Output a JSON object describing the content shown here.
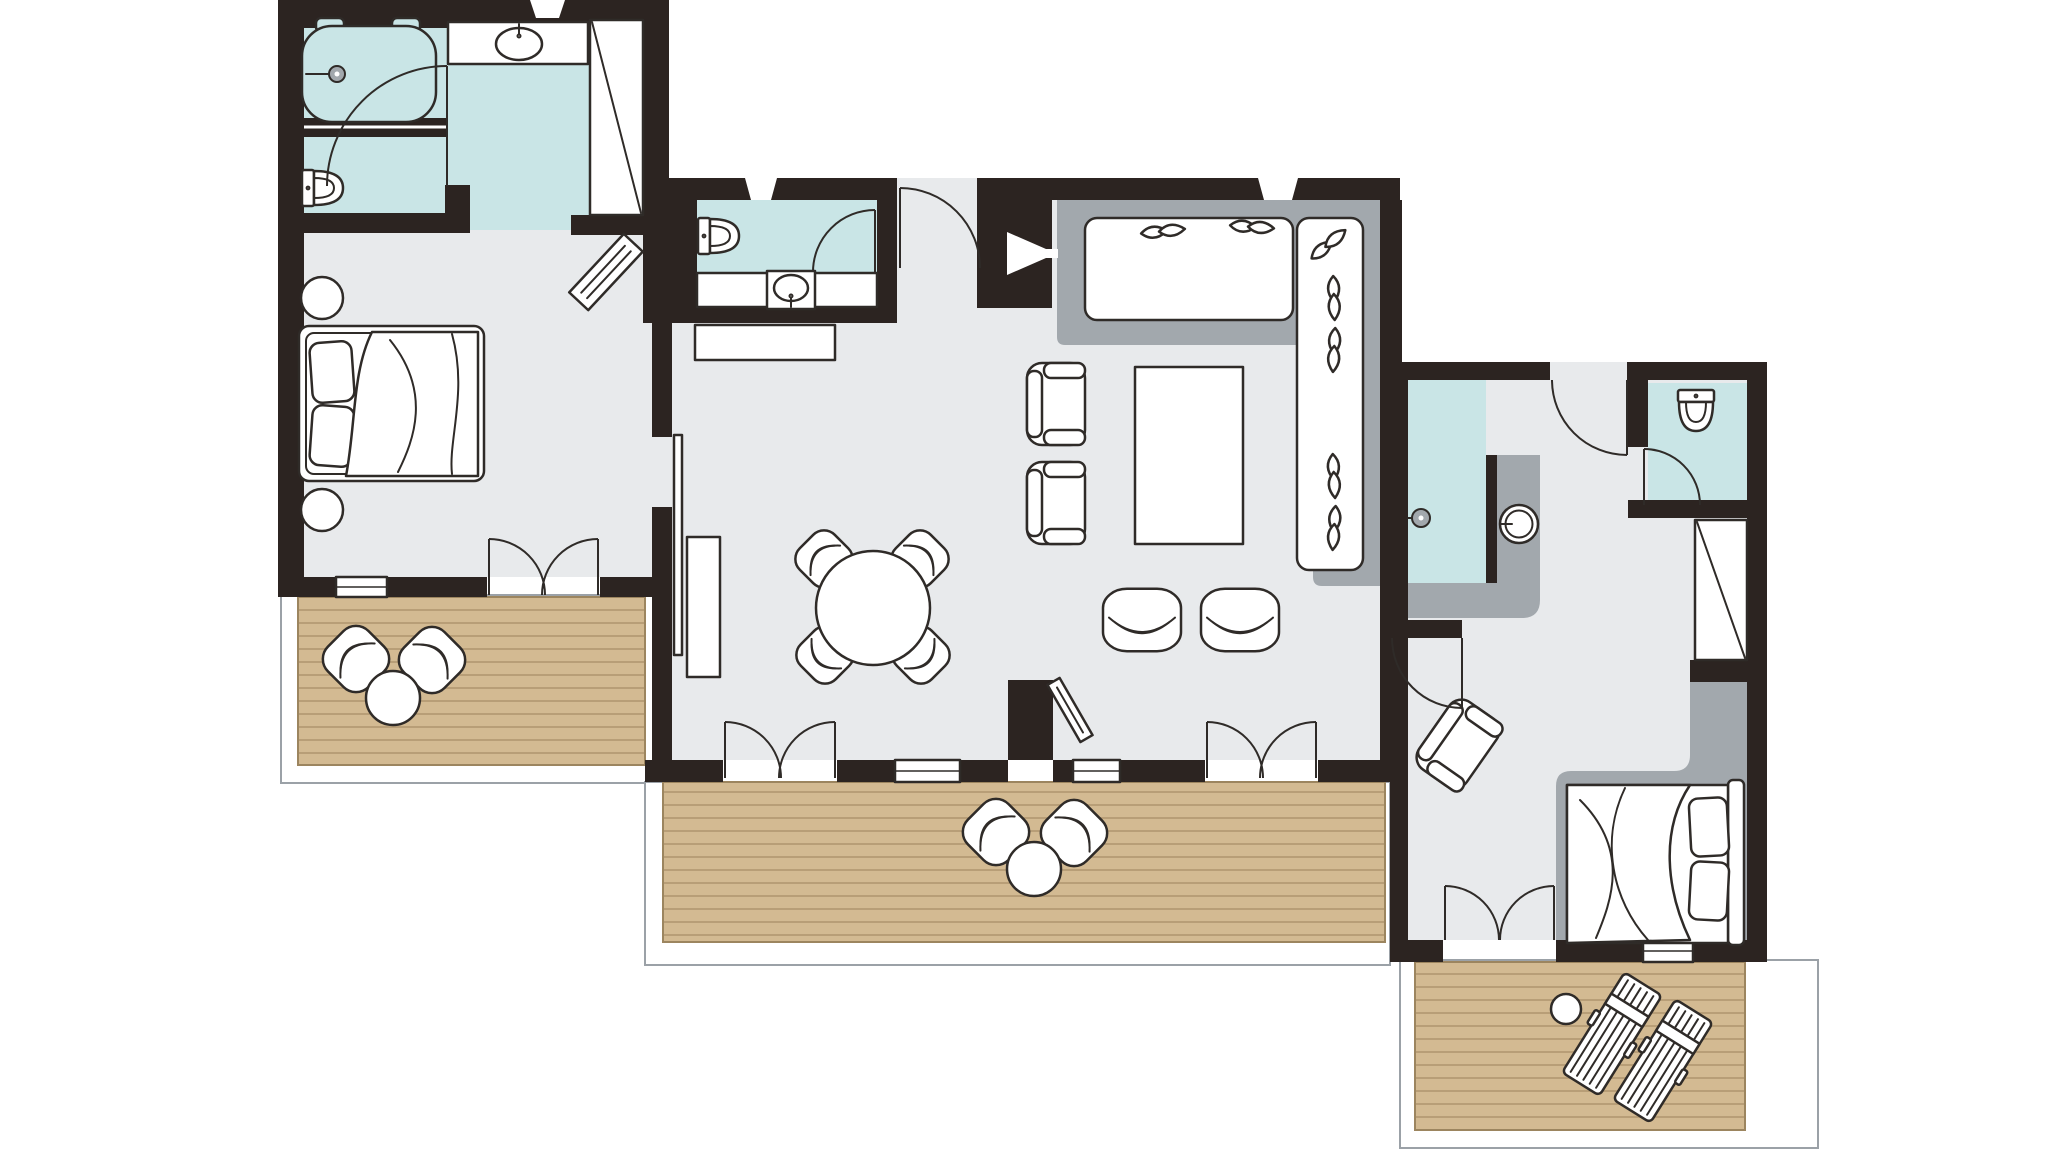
{
  "colors": {
    "bg": "#ffffff",
    "wall": "#2c2421",
    "floor": "#e8eaec",
    "bath": "#c9e5e6",
    "deck": "#d3ba92",
    "deck_line": "#b89e77",
    "deck_edge": "#9c855f",
    "accent": "#a2a8ad",
    "stroke": "#2f2b28",
    "frame": "#9ba1a7",
    "white": "#ffffff"
  },
  "floorplan": {
    "type": "two-bedroom suite floor plan",
    "units": [
      {
        "name": "master bedroom unit",
        "rooms": [
          "bathroom",
          "wc compartment",
          "bedroom",
          "terrace"
        ],
        "furniture": [
          "bathtub",
          "washbasin",
          "toilet",
          "wardrobe",
          "double bed",
          "nightstand",
          "nightstand",
          "luggage bench",
          "terrace chair",
          "terrace chair",
          "terrace table"
        ]
      },
      {
        "name": "living unit",
        "rooms": [
          "guest bathroom",
          "entrance hall",
          "living room",
          "dining area",
          "terrace"
        ],
        "furniture": [
          "toilet",
          "washbasin",
          "console table",
          "corner sofa",
          "sofa cushions",
          "coffee table",
          "armchair",
          "armchair",
          "lounge chair",
          "lounge chair",
          "tv panel",
          "round dining table",
          "dining chair",
          "dining chair",
          "dining chair",
          "dining chair",
          "sideboard",
          "sliding door",
          "terrace chair",
          "terrace chair",
          "terrace table"
        ]
      },
      {
        "name": "second bedroom unit",
        "rooms": [
          "shower room",
          "wc",
          "dressing hall",
          "bedroom",
          "terrace"
        ],
        "furniture": [
          "walk-in shower",
          "shower head",
          "washbasin",
          "toilet",
          "wardrobe",
          "double bed",
          "armchair",
          "sun lounger",
          "sun lounger",
          "side table"
        ]
      }
    ]
  }
}
